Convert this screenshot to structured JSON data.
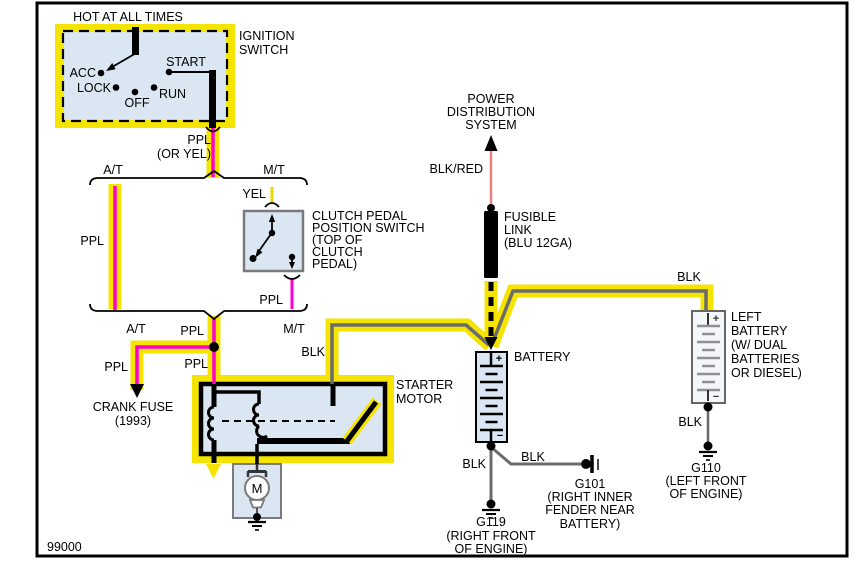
{
  "colors": {
    "highlight_yellow": "#F5E400",
    "ppl_magenta": "#FF00CD",
    "yel_wire": "#EFD800",
    "blk_wire_gray": "#6B6B6B",
    "blkred_pink": "#ED8080",
    "component_fill_blue": "#DAE7F2",
    "black": "#000000"
  },
  "ignition": {
    "hot": "HOT AT ALL TIMES",
    "name": [
      "IGNITION",
      "SWITCH"
    ],
    "positions": {
      "acc": "ACC",
      "lock": "LOCK",
      "off": "OFF",
      "run": "RUN",
      "start": "START"
    },
    "out": [
      "PPL",
      "(OR YEL)"
    ]
  },
  "split_top": {
    "at": "A/T",
    "mt": "M/T"
  },
  "split_bottom": {
    "at": "A/T",
    "mt": "M/T"
  },
  "wires": {
    "at_ppl": "PPL",
    "yel": "YEL",
    "clutch_out": "PPL",
    "merge_ppl": "PPL",
    "junction_ppl": "PPL",
    "crank_ppl": "PPL",
    "starter_blk": "BLK",
    "blkred": "BLK/RED",
    "left_batt_blk_top": "BLK",
    "left_batt_blk_bottom": "BLK",
    "g119_blk": "BLK",
    "g101_blk": "BLK"
  },
  "clutch": {
    "label": [
      "CLUTCH PEDAL",
      "POSITION SWITCH",
      "(TOP OF",
      "CLUTCH",
      "PEDAL)"
    ]
  },
  "crank_fuse": {
    "label": [
      "CRANK FUSE",
      "(1993)"
    ]
  },
  "starter": {
    "label": [
      "STARTER",
      "MOTOR"
    ],
    "motor_letter": "M"
  },
  "pds": {
    "label": [
      "POWER",
      "DISTRIBUTION",
      "SYSTEM"
    ]
  },
  "fusible": {
    "label": [
      "FUSIBLE",
      "LINK",
      "(BLU 12GA)"
    ]
  },
  "battery": {
    "label": "BATTERY",
    "plus": "+",
    "minus": "−"
  },
  "left_battery": {
    "label": [
      "LEFT",
      "BATTERY",
      "(W/ DUAL",
      "BATTERIES",
      "OR DIESEL)"
    ],
    "plus": "+",
    "minus": "−"
  },
  "g119": {
    "label": [
      "G119",
      "(RIGHT FRONT",
      "OF ENGINE)"
    ]
  },
  "g101": {
    "label": [
      "G101",
      "(RIGHT INNER",
      "FENDER NEAR",
      "BATTERY)"
    ]
  },
  "g110": {
    "label": [
      "G110",
      "(LEFT FRONT",
      "OF ENGINE)"
    ]
  },
  "code": "99000"
}
